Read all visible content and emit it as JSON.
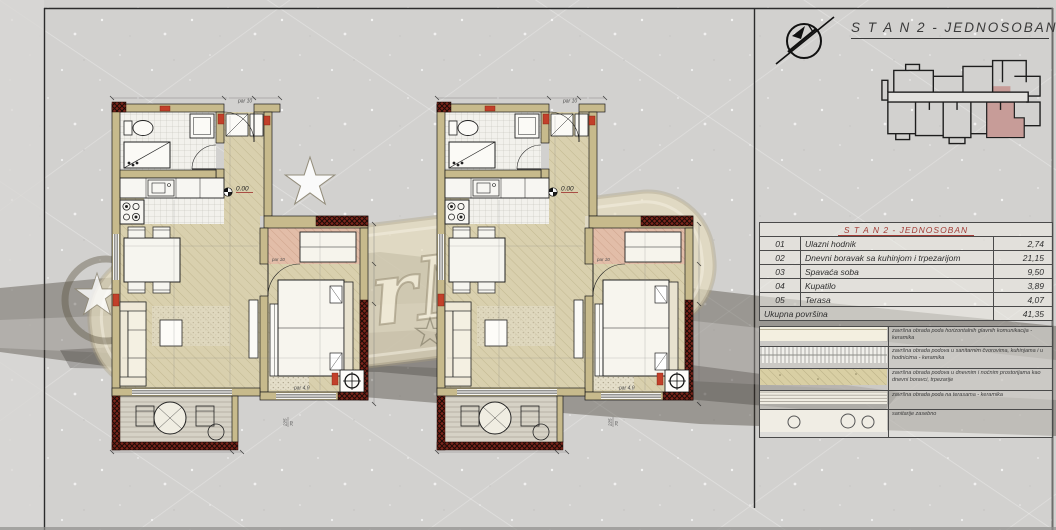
{
  "sheet": {
    "title": "S T A N  2 - JEDNOSOBAN"
  },
  "plan": {
    "level": "0.00",
    "dim_entry": "par 10",
    "dim_terrace": "par 4.0",
    "win_a": "225",
    "win_b": "70"
  },
  "table": {
    "header": "S T A N  2 - JEDNOSOBAN",
    "rows": [
      {
        "no": "01",
        "name": "Ulazni hodnik",
        "area": "2,74"
      },
      {
        "no": "02",
        "name": "Dnevni boravak sa kuhinjom i trpezarijom",
        "area": "21,15"
      },
      {
        "no": "03",
        "name": "Spavaća soba",
        "area": "9,50"
      },
      {
        "no": "04",
        "name": "Kupatilo",
        "area": "3,89"
      },
      {
        "no": "05",
        "name": "Terasa",
        "area": "4,07"
      }
    ],
    "total_label": "Ukupna površina",
    "total_value": "41,35"
  },
  "legend": {
    "rows": [
      {
        "swatch": "plain",
        "text": "završna obrada poda horizontalnih glavnih komunikacija - keramika"
      },
      {
        "swatch": "grid",
        "text": "završna obrada podova u sanitarnim čvorovima, kuhinjama i u hodnicima - keramika"
      },
      {
        "swatch": "sand",
        "text": "završna obrada podova u dnevnim i noćnim prostorijama kao dnevni boravci, trpezarije"
      },
      {
        "swatch": "hlines",
        "text": "završna obrada poda na terasama - keramika"
      },
      {
        "swatch": "circles",
        "text": "sanitarije zasebno"
      }
    ]
  },
  "watermark": {
    "text": "WaterMark"
  },
  "colors": {
    "accent_red": "#a33c36",
    "highlight": "#c79c98",
    "wall": "#c7ba8c"
  }
}
